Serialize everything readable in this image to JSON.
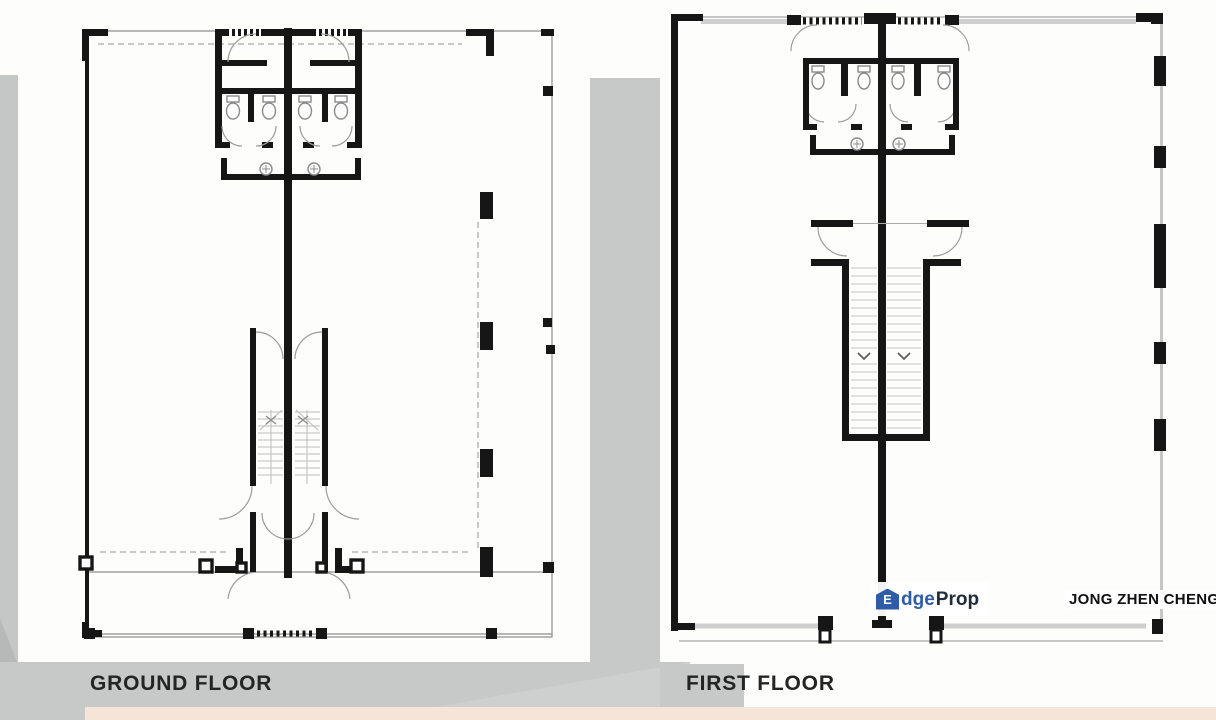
{
  "plans": [
    {
      "id": "ground-floor",
      "label": "GROUND FLOOR"
    },
    {
      "id": "first-floor",
      "label": "FIRST FLOOR"
    }
  ],
  "watermark": {
    "brand_full": "EdgeProp",
    "brand_house_initial": "E",
    "brand_mid": "dge",
    "brand_tail": "Prop",
    "agent_name": "JONG ZHEN CHENG"
  },
  "colors": {
    "wall_line": "#161616",
    "light_line": "#9a9a9a",
    "window_line": "#cfcfcf",
    "gray_band": "#c6c9c7",
    "pink_strip": "#f7e4d8",
    "brand_blue": "#2e5ca9",
    "brand_dark": "#222d3c",
    "label_text": "#242424"
  }
}
